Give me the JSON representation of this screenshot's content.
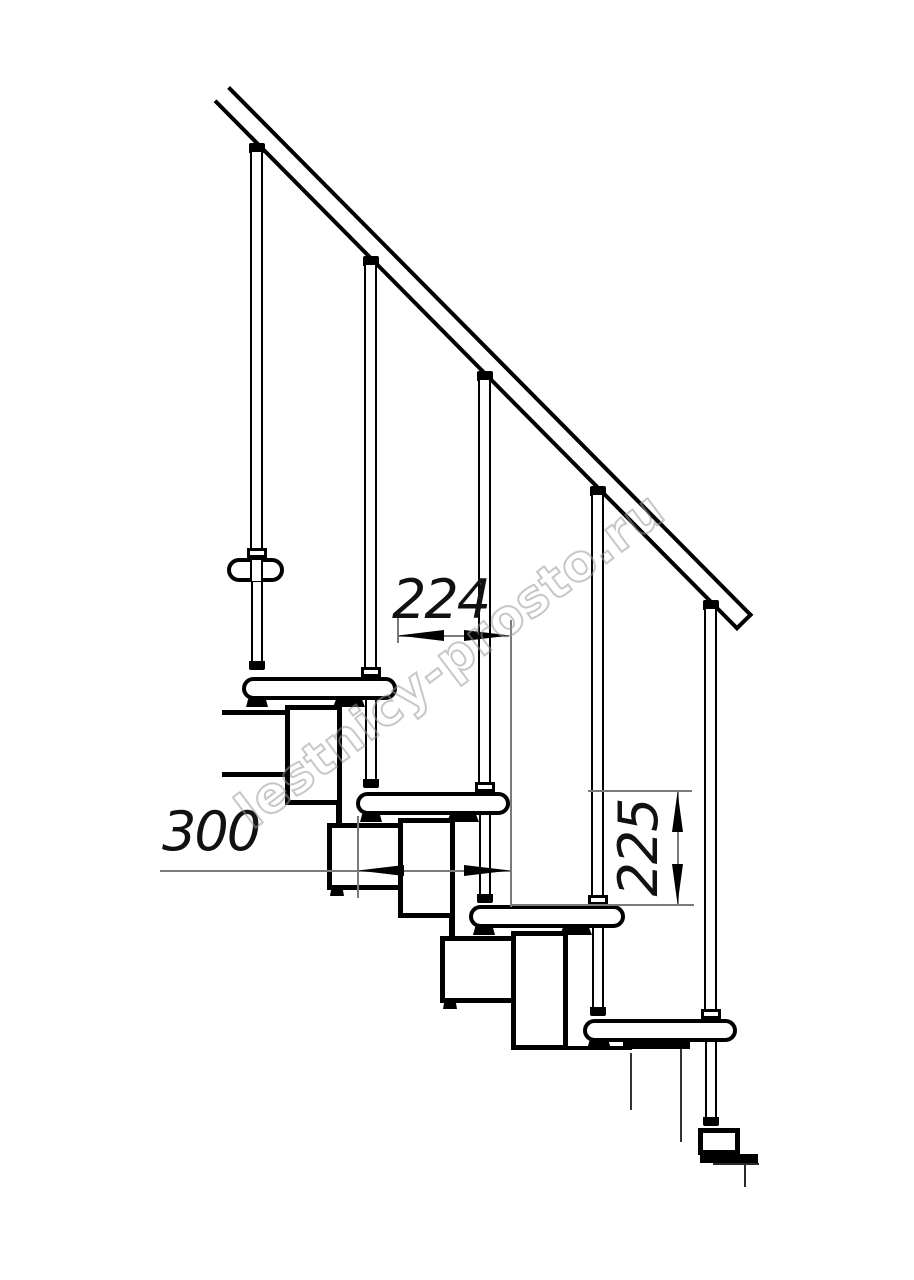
{
  "drawing": {
    "title": "modular-staircase-side-elevation",
    "dimensions": {
      "tread_spacing_mm": "224",
      "step_run_mm": "300",
      "riser_height_mm": "225"
    },
    "watermark_text": "lestnicy-prosto.ru",
    "colors": {
      "line": "#000000",
      "dimension_line": "#7a7a7a",
      "watermark": "#9a9a9a",
      "background": "#ffffff"
    }
  }
}
